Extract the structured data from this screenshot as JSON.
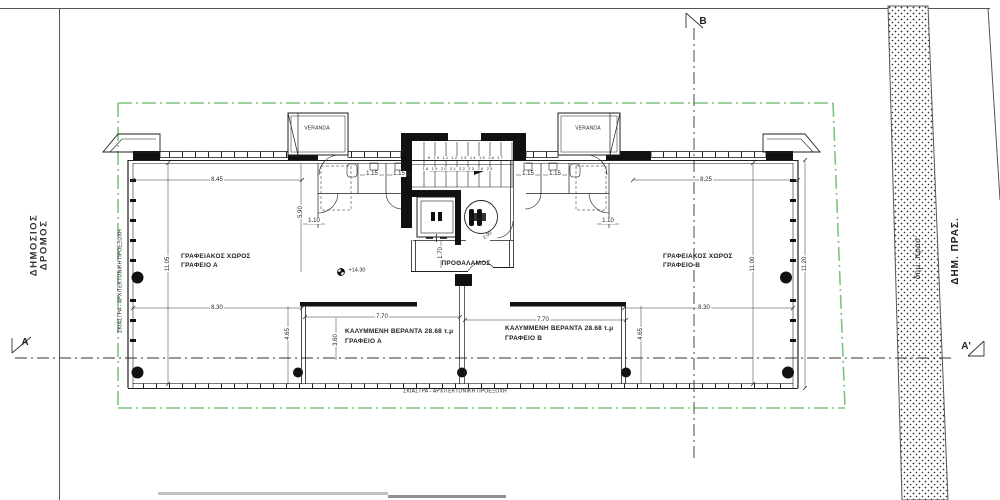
{
  "site": {
    "public_road": {
      "line1": "ΔΗΜΟΣΙΟΣ",
      "line2": "ΔΡΟΜΟΣ"
    },
    "municipal_green": "ΔΗΜ. ΠΡΑΣ.",
    "municipal_green_small": "δημ. πρασ:"
  },
  "markers": {
    "a": "A",
    "a_prime": "A'",
    "b": "B"
  },
  "labels": {
    "office_space": "ΓΡΑΦΕΙΑΚΟΣ ΧΩΡΟΣ",
    "office_a": "ΓΡΑΦΕΙΟ Α",
    "office_b": "ΓΡΑΦΕΙΟ Β",
    "vestibule": "ΠΡΟΘΑΛΑΜΟΣ",
    "covered_veranda": "ΚΑΛΥΜΜΕΝΗ ΒΕΡΑΝΤΑ 28.68 τ.μ",
    "veranda": "VERANDA",
    "louvre_note": "ΣΚΙΑΣΤΡΑ - ΑΡΧΙΤΕΚΤΟΝΙΚΗ ΠΡΟΕΞΟΧΗ",
    "level": "+14.30"
  },
  "dimensions": {
    "w845": "8.45",
    "w825": "8.25",
    "h1105": "11.05",
    "h1100": "11.00",
    "h1120": "11.20",
    "w830": "8.30",
    "w770": "7.70",
    "h465": "4.65",
    "h360": "3.60",
    "h170": "1.70",
    "h590": "5.90",
    "w110": "1.10",
    "w115": "1.15",
    "w200": "2.00"
  },
  "stairs": {
    "row1": "9 10 11 12 13 14 15 16 17",
    "row2": "18 19 20 21 22 23 24 25"
  },
  "colors": {
    "boundary_green": "#7cc47c",
    "ink": "#1f1f1f"
  }
}
